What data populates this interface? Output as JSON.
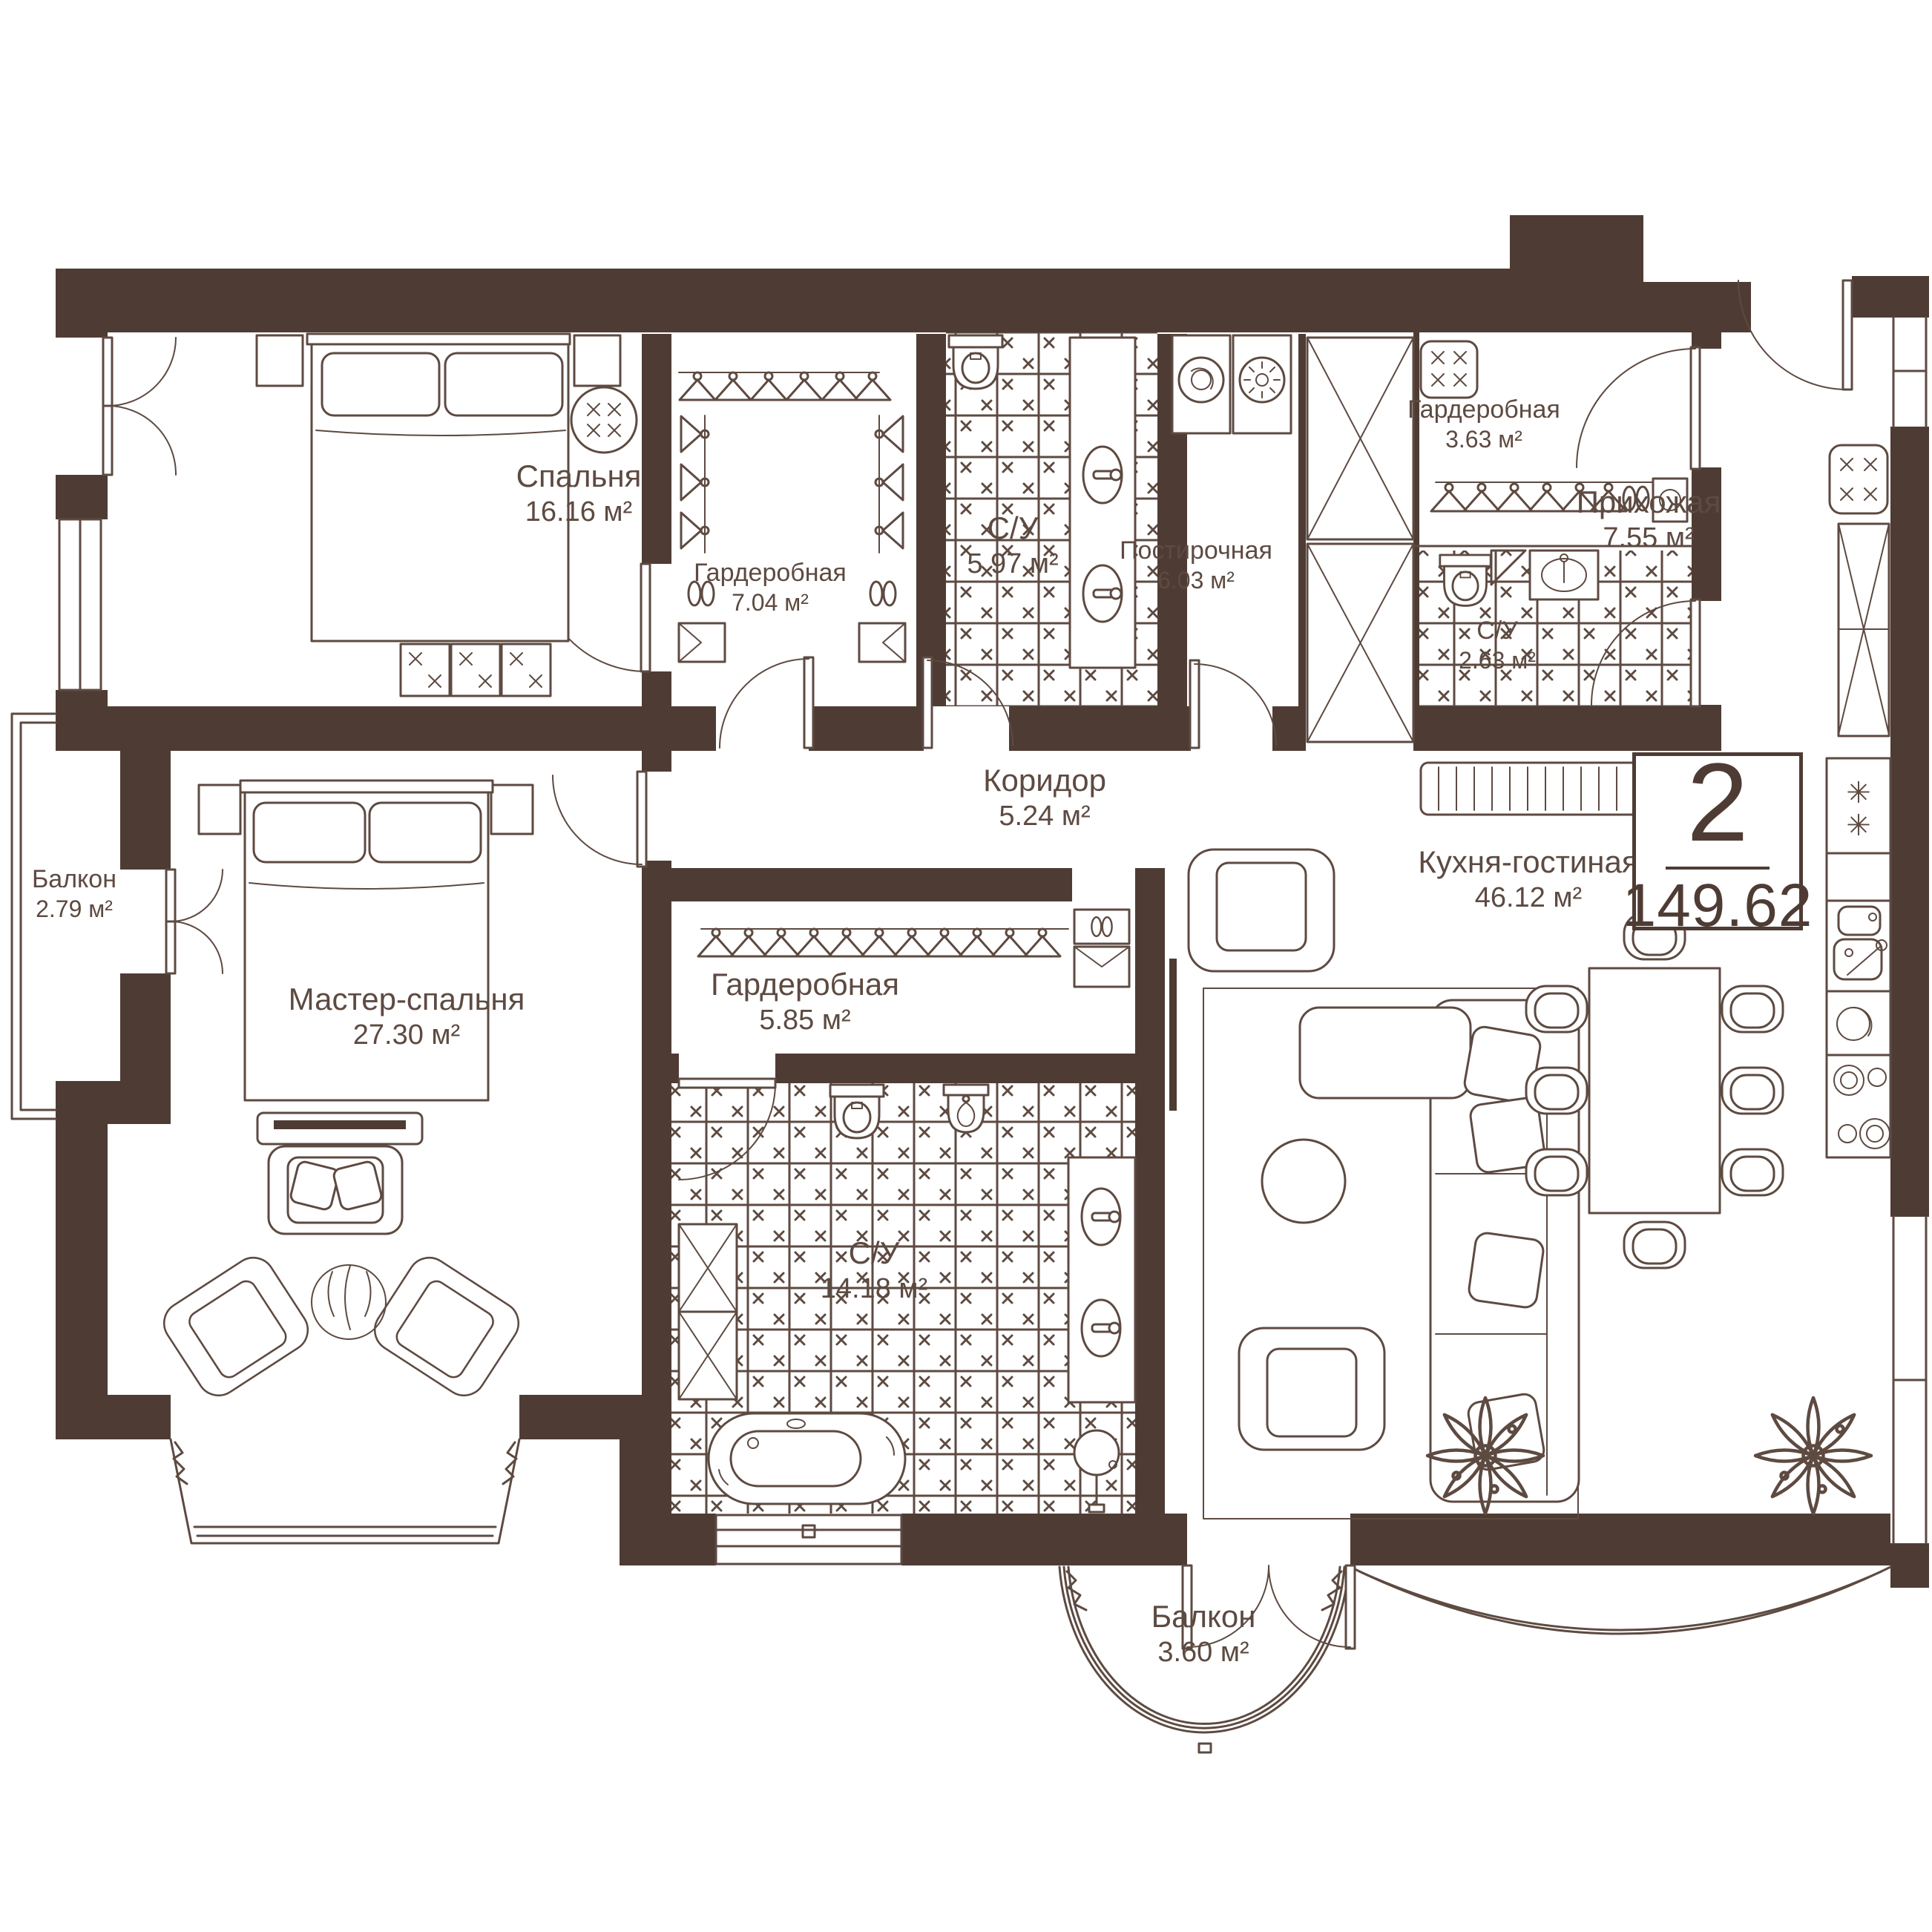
{
  "plan": {
    "badge": {
      "rooms": "2",
      "area": "149.62"
    },
    "rooms": [
      {
        "id": "bedroom",
        "name": "Спальня",
        "area": "16.16 м²"
      },
      {
        "id": "wardrobe-1",
        "name": "Гардеробная",
        "area": "7.04 м²"
      },
      {
        "id": "bathroom-1",
        "name": "С/У",
        "area": "5.97 м²"
      },
      {
        "id": "laundry",
        "name": "Постирочная",
        "area": "6.03 м²"
      },
      {
        "id": "wardrobe-2",
        "name": "Гардеробная",
        "area": "3.63 м²"
      },
      {
        "id": "hallway",
        "name": "Прихожая",
        "area": "7.55 м²"
      },
      {
        "id": "bathroom-2",
        "name": "С/У",
        "area": "2.63 м²"
      },
      {
        "id": "corridor",
        "name": "Коридор",
        "area": "5.24 м²"
      },
      {
        "id": "kitchen-living",
        "name": "Кухня-гостиная",
        "area": "46.12 м²"
      },
      {
        "id": "wardrobe-3",
        "name": "Гардеробная",
        "area": "5.85 м²"
      },
      {
        "id": "bathroom-3",
        "name": "С/У",
        "area": "14.18 м²"
      },
      {
        "id": "master-bedroom",
        "name": "Мастер-спальня",
        "area": "27.30 м²"
      },
      {
        "id": "balcony-left",
        "name": "Балкон",
        "area": "2.79 м²"
      },
      {
        "id": "balcony-bottom",
        "name": "Балкон",
        "area": "3.60 м²"
      }
    ],
    "icons": {
      "freezer_mark_1": "✳",
      "freezer_mark_2": "✳"
    },
    "colors": {
      "wall": "#4E3C34",
      "line": "#5D4A41",
      "tile_bg": "#FDF8F6",
      "tile_mark": "#E8CFC5",
      "background": "#FFFFFF",
      "text": "#5D4A41"
    }
  }
}
